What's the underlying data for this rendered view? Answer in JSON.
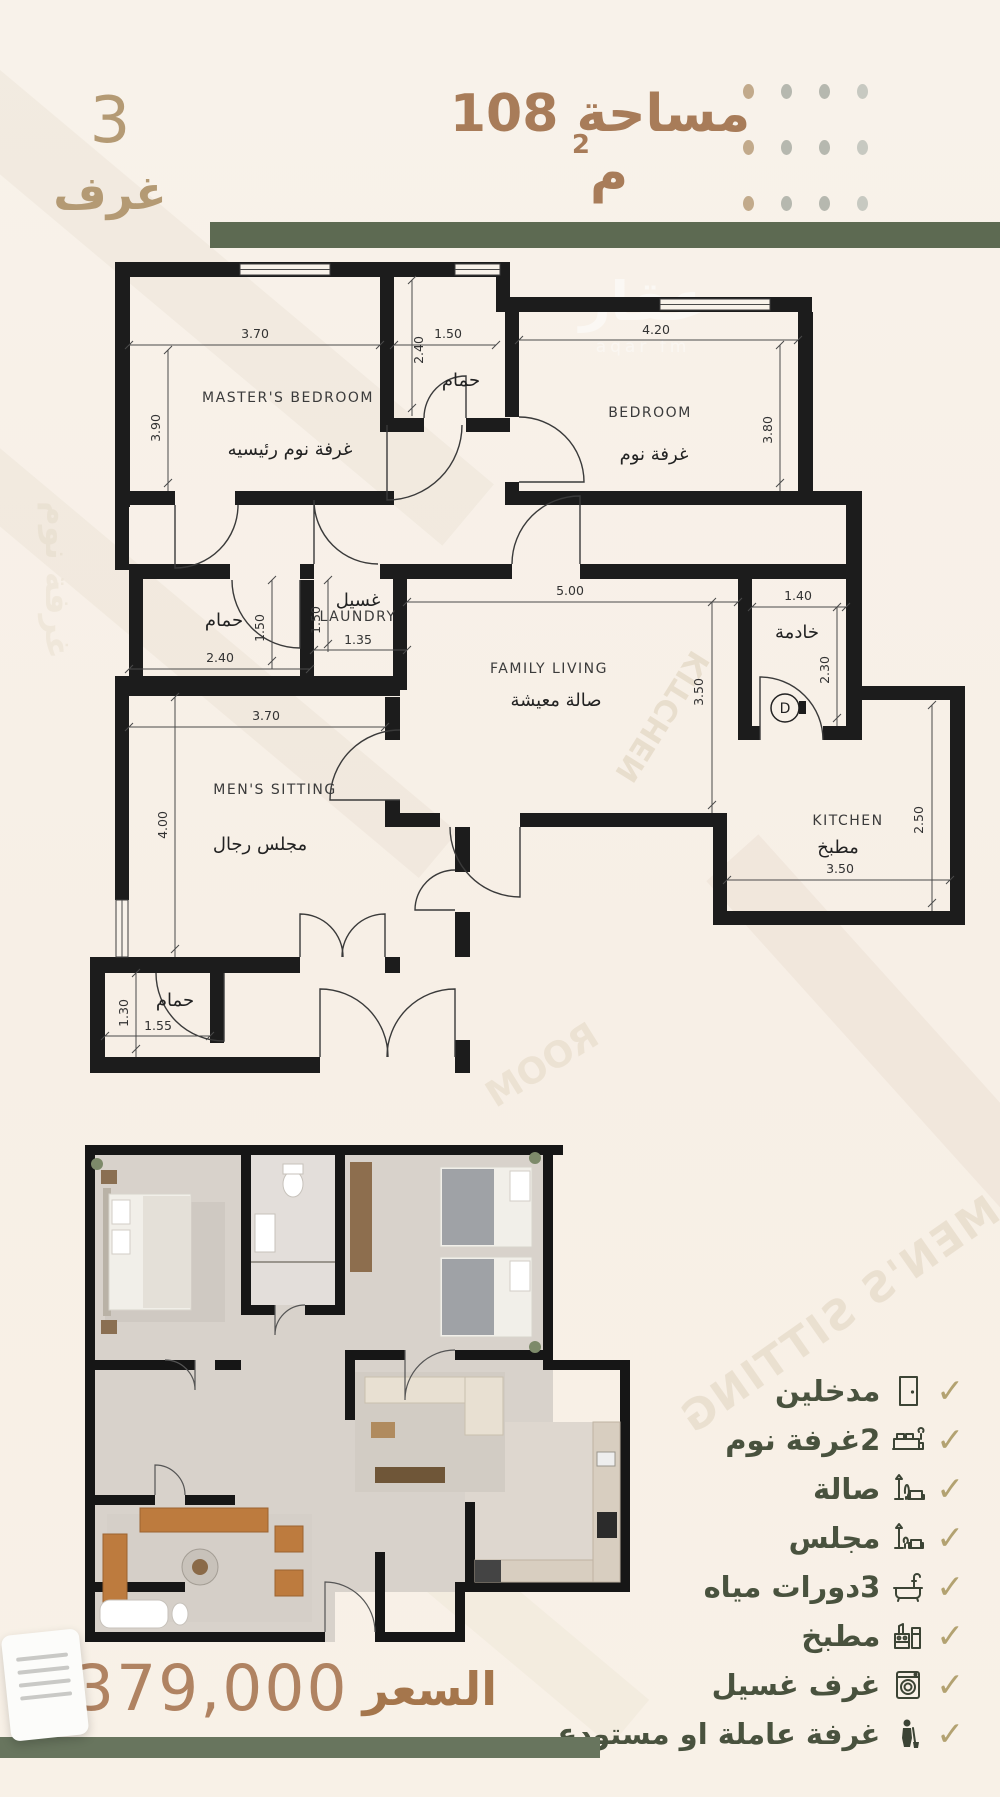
{
  "header": {
    "area_label": "مساحة 108 م",
    "area_sup": "2",
    "rooms_count": "3",
    "rooms_word": "غرف"
  },
  "watermarks": {
    "logo_ar": "عقار",
    "logo_en": "aqar fm",
    "ghosts": [
      "MEN'S SITTING",
      "KITCHEN",
      "ROOM",
      "غرفة نوم"
    ]
  },
  "plan": {
    "rooms": [
      {
        "en": "MASTER'S BEDROOM",
        "ar": "غرفة نوم رئيسيه",
        "w": "3.70",
        "h": "3.90"
      },
      {
        "ar": "حمام",
        "w": "1.50",
        "h": "2.40"
      },
      {
        "en": "BEDROOM",
        "ar": "غرفة نوم",
        "w": "4.20",
        "h": "3.80"
      },
      {
        "ar": "حمام",
        "w": "2.40",
        "h": "1.50"
      },
      {
        "en": "LAUNDRY",
        "ar": "غسيل",
        "w": "1.35",
        "h": "1.50"
      },
      {
        "en": "FAMILY LIVING",
        "ar": "صالة معيشة",
        "w": "5.00",
        "h": "3.50"
      },
      {
        "ar": "خادمة",
        "w": "1.40",
        "h": "2.30",
        "door": "D"
      },
      {
        "en": "MEN'S SITTING",
        "ar": "مجلس رجال",
        "w": "3.70",
        "h": "4.00"
      },
      {
        "en": "KITCHEN",
        "ar": "مطبخ",
        "w": "3.50",
        "h": "2.50"
      },
      {
        "ar": "حمام",
        "w": "1.55",
        "h": "1.30"
      }
    ]
  },
  "features": {
    "check_glyph": "✓",
    "items": [
      {
        "label": "مدخلين",
        "icon": "door-icon"
      },
      {
        "label": "2غرفة نوم",
        "icon": "bed-icon"
      },
      {
        "label": "صالة",
        "icon": "sofa-lamp-icon"
      },
      {
        "label": "مجلس",
        "icon": "armchair-lamp-icon"
      },
      {
        "label": "3دورات مياه",
        "icon": "bathtub-icon"
      },
      {
        "label": "مطبخ",
        "icon": "stove-icon"
      },
      {
        "label": "غرف غسيل",
        "icon": "washing-machine-icon"
      },
      {
        "label": "غرفة عاملة او مستودع",
        "icon": "worker-icon"
      }
    ]
  },
  "price": {
    "label": "السعر",
    "value": "379,000",
    "currency_icon": "saudi-riyal"
  },
  "colors": {
    "accent_brown": "#a87c59",
    "accent_tan": "#b49a74",
    "olive_bar": "#5d6a52",
    "feature_text": "#49523e",
    "check_tan": "#b3a271"
  }
}
